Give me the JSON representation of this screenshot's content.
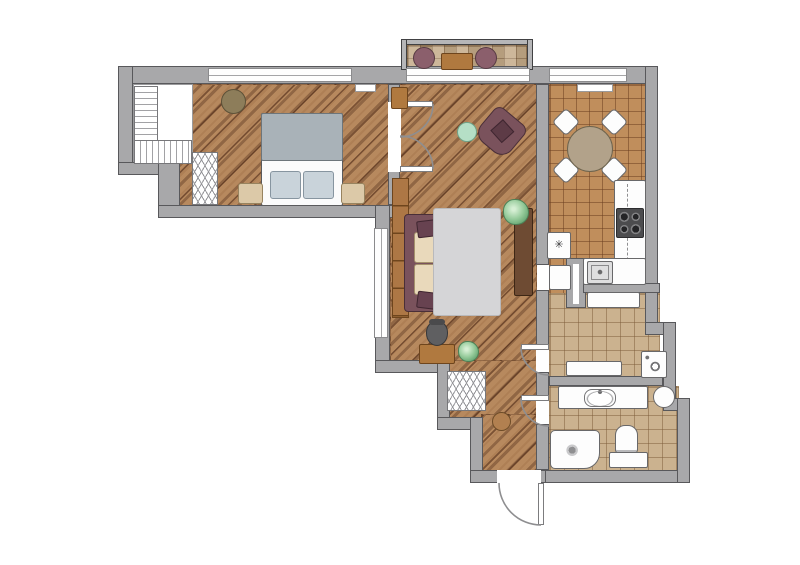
{
  "colors": {
    "wall": "#a8a8aa",
    "wall_border": "#58585b",
    "wood_floor": "#b7895e",
    "kitchen_tile": "#c08e5c",
    "hall_tile": "#cbb28f",
    "balcony_tile": "#c3a987",
    "mauve_furniture": "#7a525c",
    "cushion_beige": "#e9d9bb",
    "rug_gray": "#d5d5d7",
    "blanket_gray": "#a9b2b8",
    "mint": "#b5dfc6",
    "nightstand_beige": "#dcc9a8",
    "furniture_white": "#fdfdfd"
  },
  "plan": {
    "canvas": {
      "w": 800,
      "h": 565
    },
    "floors": [
      {
        "name": "bedroom-wood-floor",
        "cls": "f-wood",
        "x": 158,
        "y": 84,
        "w": 232,
        "h": 123
      },
      {
        "name": "bedroom-closet-floor",
        "cls": "f-closet",
        "x": 133,
        "y": 84,
        "w": 60,
        "h": 80
      },
      {
        "name": "living-room-wood-floor",
        "cls": "f-wood",
        "x": 390,
        "y": 84,
        "w": 147,
        "h": 289
      },
      {
        "name": "entry-hall-wood-floor",
        "cls": "f-wood",
        "x": 447,
        "y": 360,
        "w": 90,
        "h": 58
      },
      {
        "name": "entry-hall-wood-floor-lower",
        "cls": "f-wood",
        "x": 481,
        "y": 414,
        "w": 56,
        "h": 58
      },
      {
        "name": "kitchen-tile-floor",
        "cls": "f-kitchen",
        "x": 549,
        "y": 84,
        "w": 97,
        "h": 211
      },
      {
        "name": "hallway-tile-floor",
        "cls": "f-hall",
        "x": 549,
        "y": 293,
        "w": 111,
        "h": 85
      },
      {
        "name": "bathroom-tile-floor",
        "cls": "f-hall",
        "x": 549,
        "y": 386,
        "w": 130,
        "h": 86
      },
      {
        "name": "balcony-tile-floor",
        "cls": "f-balcony",
        "x": 407,
        "y": 45,
        "w": 120,
        "h": 25
      }
    ],
    "walls": [
      {
        "name": "wall-top",
        "cls": "wall",
        "x": 118,
        "y": 66,
        "w": 540,
        "h": 18
      },
      {
        "name": "wall-left-upper",
        "cls": "wall",
        "x": 118,
        "y": 66,
        "w": 15,
        "h": 109
      },
      {
        "name": "wall-left-step",
        "cls": "wall",
        "x": 118,
        "y": 162,
        "w": 62,
        "h": 13
      },
      {
        "name": "wall-left-mid",
        "cls": "wall",
        "x": 158,
        "y": 162,
        "w": 22,
        "h": 56
      },
      {
        "name": "wall-bedroom-south",
        "cls": "wall",
        "x": 158,
        "y": 205,
        "w": 237,
        "h": 13
      },
      {
        "name": "wall-living-west",
        "cls": "wall",
        "x": 375,
        "y": 205,
        "w": 15,
        "h": 168
      },
      {
        "name": "wall-entry-step-h1",
        "cls": "wall",
        "x": 375,
        "y": 360,
        "w": 75,
        "h": 13
      },
      {
        "name": "wall-entry-step-v1",
        "cls": "wall",
        "x": 437,
        "y": 360,
        "w": 13,
        "h": 60
      },
      {
        "name": "wall-entry-step-h2",
        "cls": "wall",
        "x": 437,
        "y": 417,
        "w": 46,
        "h": 13
      },
      {
        "name": "wall-entry-step-v2",
        "cls": "wall",
        "x": 470,
        "y": 417,
        "w": 13,
        "h": 57
      },
      {
        "name": "wall-entry-south",
        "cls": "wall",
        "x": 470,
        "y": 470,
        "w": 87,
        "h": 13
      },
      {
        "name": "wall-bath-south",
        "cls": "wall",
        "x": 545,
        "y": 470,
        "w": 145,
        "h": 13
      },
      {
        "name": "wall-right-upper",
        "cls": "wall",
        "x": 645,
        "y": 66,
        "w": 13,
        "h": 263
      },
      {
        "name": "wall-right-step-h1",
        "cls": "wall",
        "x": 645,
        "y": 322,
        "w": 31,
        "h": 13
      },
      {
        "name": "wall-right-mid",
        "cls": "wall",
        "x": 663,
        "y": 322,
        "w": 13,
        "h": 89
      },
      {
        "name": "wall-right-step-h2",
        "cls": "wall",
        "x": 663,
        "y": 398,
        "w": 27,
        "h": 13
      },
      {
        "name": "wall-right-lower",
        "cls": "wall",
        "x": 677,
        "y": 398,
        "w": 13,
        "h": 85
      },
      {
        "name": "wall-bedroom-living",
        "cls": "wall",
        "x": 388,
        "y": 84,
        "w": 12,
        "h": 121
      },
      {
        "name": "wall-living-kitchen",
        "cls": "wall",
        "x": 536,
        "y": 84,
        "w": 13,
        "h": 181
      },
      {
        "name": "wall-hall-west-a",
        "cls": "wall",
        "x": 536,
        "y": 290,
        "w": 13,
        "h": 55
      },
      {
        "name": "wall-hall-west-b",
        "cls": "wall",
        "x": 536,
        "y": 372,
        "w": 13,
        "h": 24
      },
      {
        "name": "wall-bath-west",
        "cls": "wall",
        "x": 536,
        "y": 424,
        "w": 13,
        "h": 46
      },
      {
        "name": "wall-kitchen-slide-housing",
        "cls": "wall",
        "x": 566,
        "y": 258,
        "w": 20,
        "h": 50
      },
      {
        "name": "wall-kitchen-hall",
        "cls": "wall",
        "x": 583,
        "y": 283,
        "w": 77,
        "h": 10
      },
      {
        "name": "wall-hall-bath",
        "cls": "wall",
        "x": 549,
        "y": 376,
        "w": 114,
        "h": 10
      },
      {
        "name": "balcony-wall-top",
        "cls": "wall-b",
        "x": 401,
        "y": 39,
        "w": 132,
        "h": 6
      },
      {
        "name": "balcony-wall-left",
        "cls": "wall-b",
        "x": 401,
        "y": 39,
        "w": 6,
        "h": 31
      },
      {
        "name": "balcony-wall-right",
        "cls": "wall-b",
        "x": 527,
        "y": 39,
        "w": 6,
        "h": 31
      }
    ],
    "openings": [
      {
        "name": "bedroom-window",
        "cls": "window-h",
        "x": 208,
        "y": 68,
        "w": 144,
        "h": 14
      },
      {
        "name": "balcony-door-window",
        "cls": "window-h",
        "x": 406,
        "y": 68,
        "w": 124,
        "h": 14
      },
      {
        "name": "kitchen-window",
        "cls": "window-h",
        "x": 549,
        "y": 68,
        "w": 78,
        "h": 14
      },
      {
        "name": "living-west-window",
        "cls": "window-v",
        "x": 374,
        "y": 228,
        "w": 14,
        "h": 110
      },
      {
        "name": "kitchen-window-sill",
        "cls": "sill",
        "x": 577,
        "y": 84,
        "w": 36,
        "h": 8
      },
      {
        "name": "bedroom-window-sill",
        "cls": "sill",
        "x": 355,
        "y": 84,
        "w": 21,
        "h": 8
      },
      {
        "name": "bedroom-door-gap",
        "cls": "gap",
        "x": 388,
        "y": 102,
        "w": 13,
        "h": 70
      },
      {
        "name": "entry-hall-door-gap",
        "cls": "gap",
        "x": 536,
        "y": 345,
        "w": 13,
        "h": 27
      },
      {
        "name": "entry-bath-door-gap",
        "cls": "gap",
        "x": 536,
        "y": 396,
        "w": 13,
        "h": 28
      },
      {
        "name": "entry-exterior-door-gap",
        "cls": "gap",
        "x": 497,
        "y": 470,
        "w": 44,
        "h": 13
      },
      {
        "name": "hall-niche",
        "cls": "white-furn",
        "x": 549,
        "y": 265,
        "w": 22,
        "h": 25
      },
      {
        "name": "kitchen-sliding-door-slot",
        "cls": "gap",
        "x": 573,
        "y": 264,
        "w": 6,
        "h": 40
      },
      {
        "name": "bedroom-door-leaf-1",
        "cls": "leaf",
        "x": 400,
        "y": 101,
        "w": 33,
        "h": 6
      },
      {
        "name": "bedroom-door-leaf-2",
        "cls": "leaf",
        "x": 400,
        "y": 166,
        "w": 33,
        "h": 6
      },
      {
        "name": "entry-hall-door-leaf",
        "cls": "leaf",
        "x": 521,
        "y": 344,
        "w": 28,
        "h": 6
      },
      {
        "name": "entry-bath-door-leaf",
        "cls": "leaf",
        "x": 521,
        "y": 395,
        "w": 28,
        "h": 6
      },
      {
        "name": "entry-exterior-door-leaf",
        "cls": "leaf",
        "x": 538,
        "y": 483,
        "w": 6,
        "h": 42
      }
    ],
    "furniture": [
      {
        "name": "bedroom-closet-rail-a",
        "cls": "hatch-h",
        "x": 134,
        "y": 86,
        "w": 24,
        "h": 76
      },
      {
        "name": "bedroom-closet-rail-b",
        "cls": "hatch-v",
        "x": 134,
        "y": 140,
        "w": 58,
        "h": 24
      },
      {
        "name": "bedroom-wardrobe",
        "cls": "hatch-zz",
        "x": 192,
        "y": 152,
        "w": 26,
        "h": 53
      },
      {
        "name": "bed",
        "cls": "bed-base",
        "x": 261,
        "y": 113,
        "w": 82,
        "h": 93
      },
      {
        "name": "bed-blanket",
        "cls": "blanket",
        "x": 261,
        "y": 113,
        "w": 82,
        "h": 48
      },
      {
        "name": "bed-pillow-left",
        "cls": "bed-pillow",
        "x": 270,
        "y": 171,
        "w": 31,
        "h": 28
      },
      {
        "name": "bed-pillow-right",
        "cls": "bed-pillow",
        "x": 303,
        "y": 171,
        "w": 31,
        "h": 28
      },
      {
        "name": "nightstand-left",
        "cls": "beige-furn",
        "x": 238,
        "y": 183,
        "w": 25,
        "h": 21
      },
      {
        "name": "nightstand-right",
        "cls": "beige-furn",
        "x": 341,
        "y": 183,
        "w": 24,
        "h": 21
      },
      {
        "name": "bedroom-pouf",
        "cls": "olive circle",
        "x": 221,
        "y": 89,
        "w": 25,
        "h": 25
      },
      {
        "name": "living-wall-cabinet",
        "cls": "wood-furn",
        "x": 391,
        "y": 87,
        "w": 17,
        "h": 22
      },
      {
        "name": "living-shelf-unit",
        "cls": "shelf",
        "x": 392,
        "y": 178,
        "w": 17,
        "h": 140
      },
      {
        "name": "sofa-frame",
        "cls": "mauve",
        "x": 404,
        "y": 214,
        "w": 48,
        "h": 98
      },
      {
        "name": "sofa-cushion-top",
        "cls": "cushion",
        "x": 414,
        "y": 232,
        "w": 37,
        "h": 31
      },
      {
        "name": "sofa-cushion-bottom",
        "cls": "cushion",
        "x": 414,
        "y": 264,
        "w": 37,
        "h": 31
      },
      {
        "name": "sofa-pillow-top",
        "cls": "pillow",
        "x": 417,
        "y": 220,
        "w": 24,
        "h": 17,
        "rot": -7
      },
      {
        "name": "sofa-pillow-bottom",
        "cls": "pillow",
        "x": 417,
        "y": 292,
        "w": 24,
        "h": 17,
        "rot": 7
      },
      {
        "name": "living-rug",
        "cls": "rug",
        "x": 433,
        "y": 208,
        "w": 68,
        "h": 108
      },
      {
        "name": "tv-console",
        "cls": "darkwood",
        "x": 514,
        "y": 208,
        "w": 19,
        "h": 88
      },
      {
        "name": "armchair",
        "cls": "armchair",
        "x": 481,
        "y": 112,
        "w": 40,
        "h": 40,
        "rot": 40
      },
      {
        "name": "coffee-table",
        "cls": "mint circle",
        "x": 457,
        "y": 122,
        "w": 20,
        "h": 20
      },
      {
        "name": "plant-living-north",
        "cls": "plant",
        "x": 503,
        "y": 199,
        "w": 26,
        "h": 26
      },
      {
        "name": "plant-living-south",
        "cls": "plant",
        "x": 458,
        "y": 341,
        "w": 21,
        "h": 21
      },
      {
        "name": "desk",
        "cls": "wood-furn",
        "x": 419,
        "y": 344,
        "w": 36,
        "h": 20
      },
      {
        "name": "office-chair",
        "cls": "chair-office",
        "x": 426,
        "y": 321,
        "w": 22,
        "h": 25
      },
      {
        "name": "dining-chair-nw",
        "cls": "chair-k",
        "x": 556,
        "y": 112,
        "w": 20,
        "h": 20,
        "rot": 45
      },
      {
        "name": "dining-chair-ne",
        "cls": "chair-k",
        "x": 604,
        "y": 112,
        "w": 20,
        "h": 20,
        "rot": 45
      },
      {
        "name": "dining-chair-sw",
        "cls": "chair-k",
        "x": 556,
        "y": 160,
        "w": 20,
        "h": 20,
        "rot": 45
      },
      {
        "name": "dining-chair-se",
        "cls": "chair-k",
        "x": 604,
        "y": 160,
        "w": 20,
        "h": 20,
        "rot": 45
      },
      {
        "name": "dining-table",
        "cls": "taupe circle",
        "x": 567,
        "y": 126,
        "w": 46,
        "h": 46
      },
      {
        "name": "kitchen-counter-right",
        "cls": "white-furn",
        "x": 614,
        "y": 180,
        "w": 32,
        "h": 103
      },
      {
        "name": "kitchen-upper-cabinet-line",
        "cls": "dash-v",
        "x": 627,
        "y": 184,
        "w": 2,
        "h": 96
      },
      {
        "name": "stove",
        "cls": "stove",
        "x": 616,
        "y": 208,
        "w": 28,
        "h": 30
      },
      {
        "name": "kitchen-counter-bottom",
        "cls": "white-furn",
        "x": 583,
        "y": 258,
        "w": 63,
        "h": 27
      },
      {
        "name": "kitchen-sink",
        "cls": "ksink",
        "x": 587,
        "y": 261,
        "w": 26,
        "h": 23
      },
      {
        "name": "fridge",
        "cls": "white-furn glyph",
        "x": 547,
        "y": 232,
        "w": 24,
        "h": 27,
        "glyph_name": "snowflake-icon",
        "glyph": "✳"
      },
      {
        "name": "hallway-cabinet",
        "cls": "white-furn",
        "x": 587,
        "y": 292,
        "w": 53,
        "h": 16
      },
      {
        "name": "hallway-bench",
        "cls": "white-furn",
        "x": 566,
        "y": 361,
        "w": 56,
        "h": 15
      },
      {
        "name": "washing-machine",
        "cls": "washer",
        "x": 641,
        "y": 351,
        "w": 26,
        "h": 27
      },
      {
        "name": "water-heater",
        "cls": "white-furn circle",
        "x": 653,
        "y": 386,
        "w": 22,
        "h": 22
      },
      {
        "name": "bathroom-counter",
        "cls": "white-furn",
        "x": 558,
        "y": 386,
        "w": 90,
        "h": 23
      },
      {
        "name": "bathroom-basin",
        "cls": "basin",
        "x": 584,
        "y": 389,
        "w": 32,
        "h": 18
      },
      {
        "name": "shower-tray",
        "cls": "shower",
        "x": 550,
        "y": 430,
        "w": 50,
        "h": 39
      },
      {
        "name": "toilet",
        "cls": "toilet",
        "x": 615,
        "y": 425,
        "w": 23,
        "h": 28
      },
      {
        "name": "bathroom-cabinet",
        "cls": "white-furn",
        "x": 609,
        "y": 452,
        "w": 39,
        "h": 16
      },
      {
        "name": "entry-closet",
        "cls": "hatch-zz",
        "x": 447,
        "y": 371,
        "w": 39,
        "h": 40
      },
      {
        "name": "entry-pouf",
        "cls": "brown-pouf circle",
        "x": 492,
        "y": 412,
        "w": 19,
        "h": 19
      },
      {
        "name": "balcony-chair-left",
        "cls": "bal-chair circle",
        "x": 413,
        "y": 47,
        "w": 22,
        "h": 22
      },
      {
        "name": "balcony-chair-right",
        "cls": "bal-chair circle",
        "x": 475,
        "y": 47,
        "w": 22,
        "h": 22
      },
      {
        "name": "balcony-table",
        "cls": "wood-furn",
        "x": 441,
        "y": 53,
        "w": 32,
        "h": 17
      }
    ],
    "arcs": [
      {
        "name": "bedroom-door-swing-1",
        "d": "M433,104 A33,33 0 0 1 400,137"
      },
      {
        "name": "bedroom-door-swing-2",
        "d": "M433,169 A33,33 0 0 0 400,136"
      },
      {
        "name": "entry-hall-door-swing",
        "d": "M521,347 A28,28 0 0 0 549,375"
      },
      {
        "name": "entry-bath-door-swing",
        "d": "M521,398 A28,28 0 0 0 549,426"
      },
      {
        "name": "entry-exterior-door-swing",
        "d": "M541,525 A42,42 0 0 1 499,483"
      }
    ]
  }
}
